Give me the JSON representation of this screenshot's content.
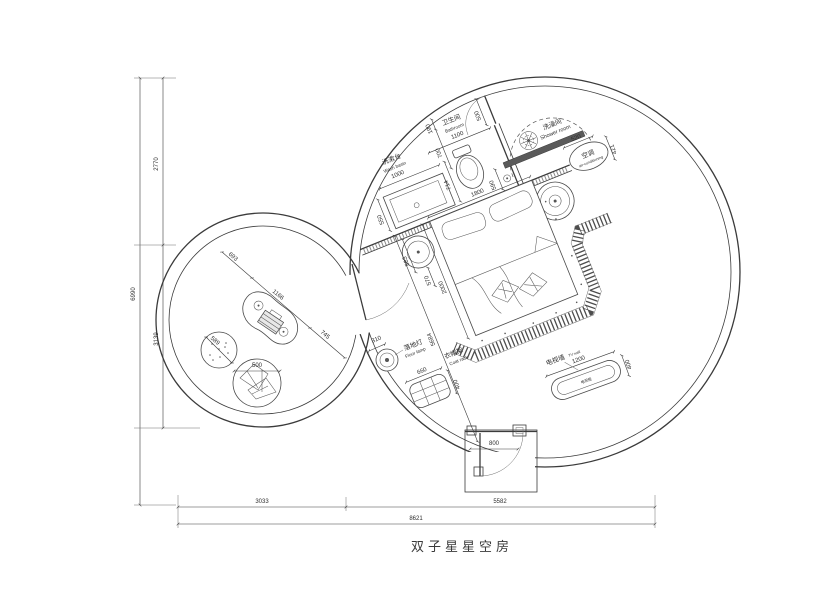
{
  "title": "双子星星空房",
  "axis": {
    "left_total": "6990",
    "left_upper": "2770",
    "left_lower": "3139",
    "bottom_seg1": "3033",
    "bottom_seg2": "5582",
    "bottom_total": "8621"
  },
  "bathroom": {
    "zh": "卫生间",
    "en": "Bathroom",
    "width": "1100",
    "d190": "190",
    "d700": "700",
    "door": "500",
    "drain": "590",
    "toilet": "714"
  },
  "washbasin": {
    "zh": "洗漱台",
    "en": "Wash basin",
    "length": "1000",
    "depth": "550"
  },
  "shower": {
    "zh": "洗澡间",
    "en": "Shower room"
  },
  "ac": {
    "zh": "空调",
    "en": "air-conditioning",
    "w": "520",
    "d": "421"
  },
  "bedroom": {
    "bed_width": "1800",
    "bed_length": "2000",
    "diag": "5684",
    "table_a": "583",
    "table_b": "570"
  },
  "tv": {
    "wall_zh": "电视墙",
    "wall_en": "TV wall",
    "cabinet_zh": "电视柜",
    "length": "1200",
    "depth": "400"
  },
  "lamp": {
    "zh": "落地灯",
    "en": "Floor lamp",
    "d": "310"
  },
  "coatrack": {
    "zh": "衣帽架",
    "en": "Coat rack",
    "w": "660",
    "d": "400"
  },
  "entry": {
    "door": "800"
  },
  "lounge": {
    "d693": "693",
    "desk": "1166",
    "pass": "745",
    "pouf": "589",
    "chair": "500"
  }
}
